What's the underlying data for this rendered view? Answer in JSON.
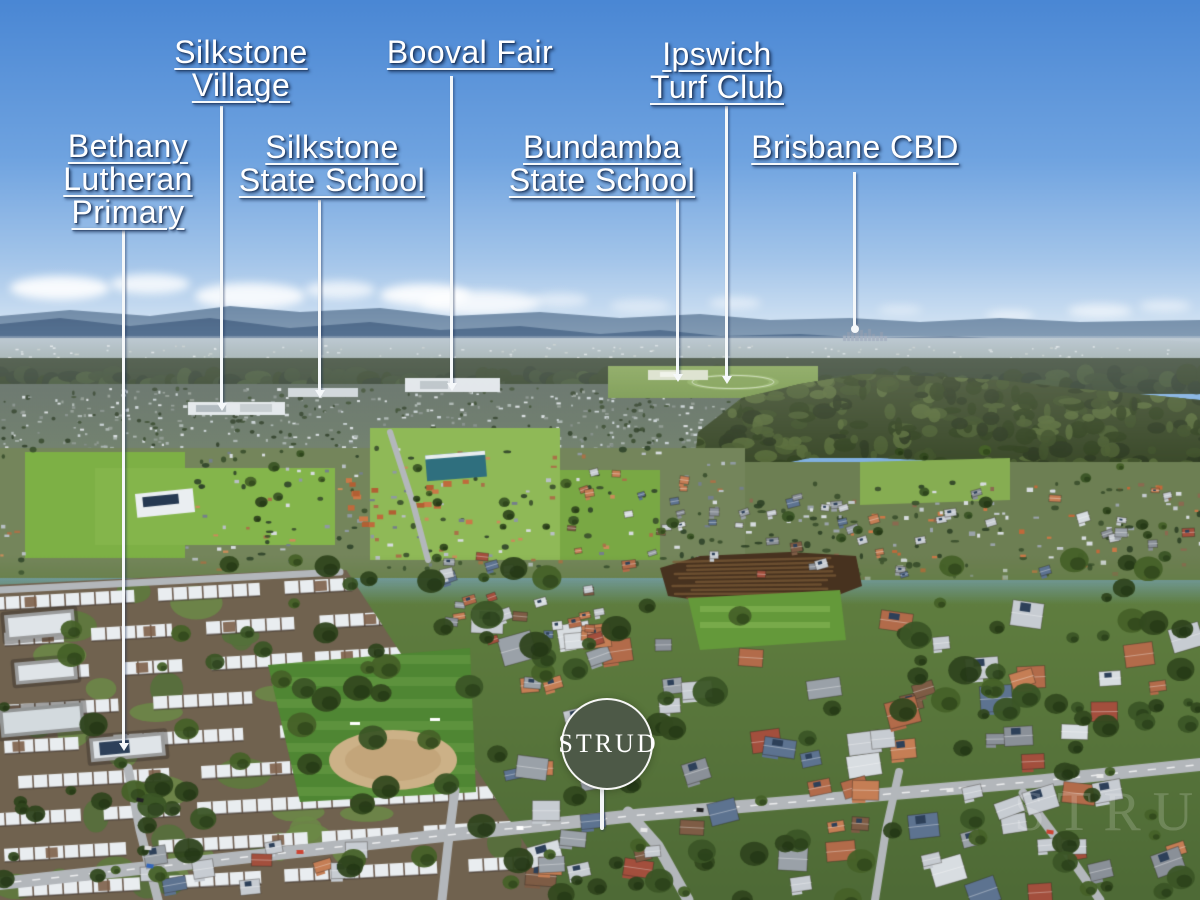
{
  "labels": [
    {
      "id": "bethany-lutheran-primary",
      "text": "Bethany\nLutheran\nPrimary"
    },
    {
      "id": "silkstone-village",
      "text": "Silkstone\nVillage"
    },
    {
      "id": "silkstone-state-school",
      "text": "Silkstone\nState School"
    },
    {
      "id": "booval-fair",
      "text": "Booval Fair"
    },
    {
      "id": "bundamba-state-school",
      "text": "Bundamba\nState School"
    },
    {
      "id": "ipswich-turf-club",
      "text": "Ipswich\nTurf Club"
    },
    {
      "id": "brisbane-cbd",
      "text": "Brisbane CBD"
    }
  ],
  "badge": {
    "text": "STRUD"
  },
  "watermark": {
    "text": "STRUD"
  },
  "colors": {
    "label_text": "#ffffff",
    "label_shadow": "#17335c",
    "leader_line": "#f5f8fa",
    "badge_bg": "#4d5947",
    "badge_text": "#ffffff",
    "sky_top": "#4a87d4",
    "sky_horizon": "#e2edf6",
    "mountain_far": "#6e89a6",
    "mountain_near": "#4d6788",
    "forest": "#394828",
    "field_green": "#7db045",
    "grass_foreground": "#5f7d3f",
    "dirt_patch": "#47321f",
    "road": "#b3b7bb"
  }
}
